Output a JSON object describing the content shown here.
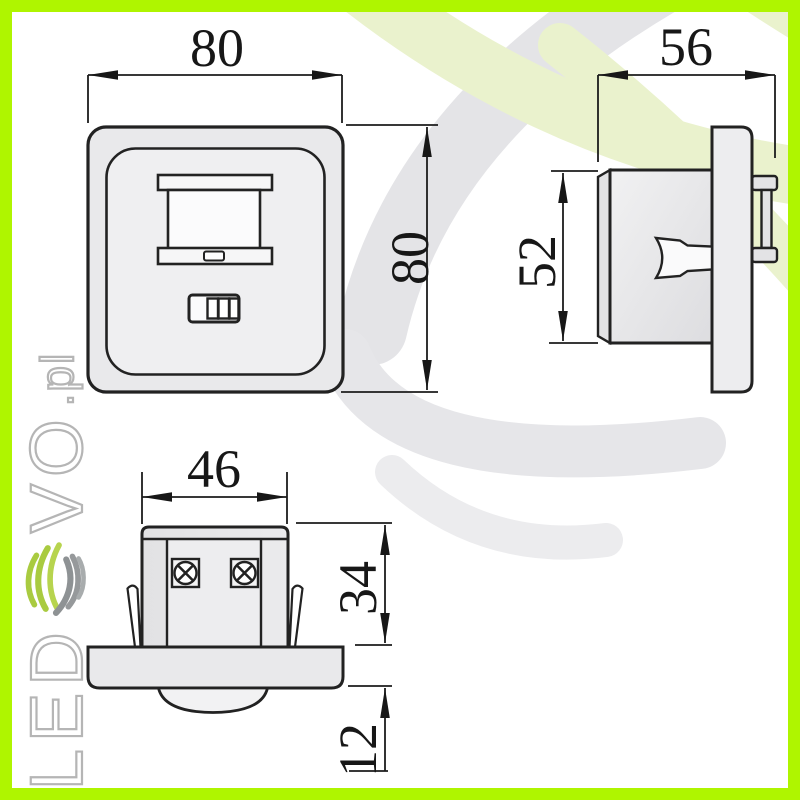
{
  "watermark": {
    "text_led": "LED",
    "text_vo": "VO",
    "text_pl": ".pl",
    "logo": "ledevo-swirl-logo"
  },
  "dimensions": {
    "front_width": "80",
    "front_height": "80",
    "side_width": "56",
    "side_height": "52",
    "bottom_width": "46",
    "recess_depth": "34",
    "flange_depth": "12"
  },
  "views": {
    "front": "front-view-of-wall-switch-pir-sensor",
    "side": "side-view-recessed-body-with-claws",
    "bottom": "bottom-view-flush-mount-sensor-with-terminals"
  },
  "colors": {
    "frame_border": "#AFF500",
    "swoosh_green": "#EAF2CD",
    "swoosh_gray": "#E4E4E7",
    "line": "#1c1c1c",
    "fill_light_gray": "#E9E9EB",
    "fill_white": "#FBFBFC",
    "logo_green": "#A9CB40",
    "logo_gray": "#96999B",
    "letter_outline": "#b5b5b5"
  }
}
